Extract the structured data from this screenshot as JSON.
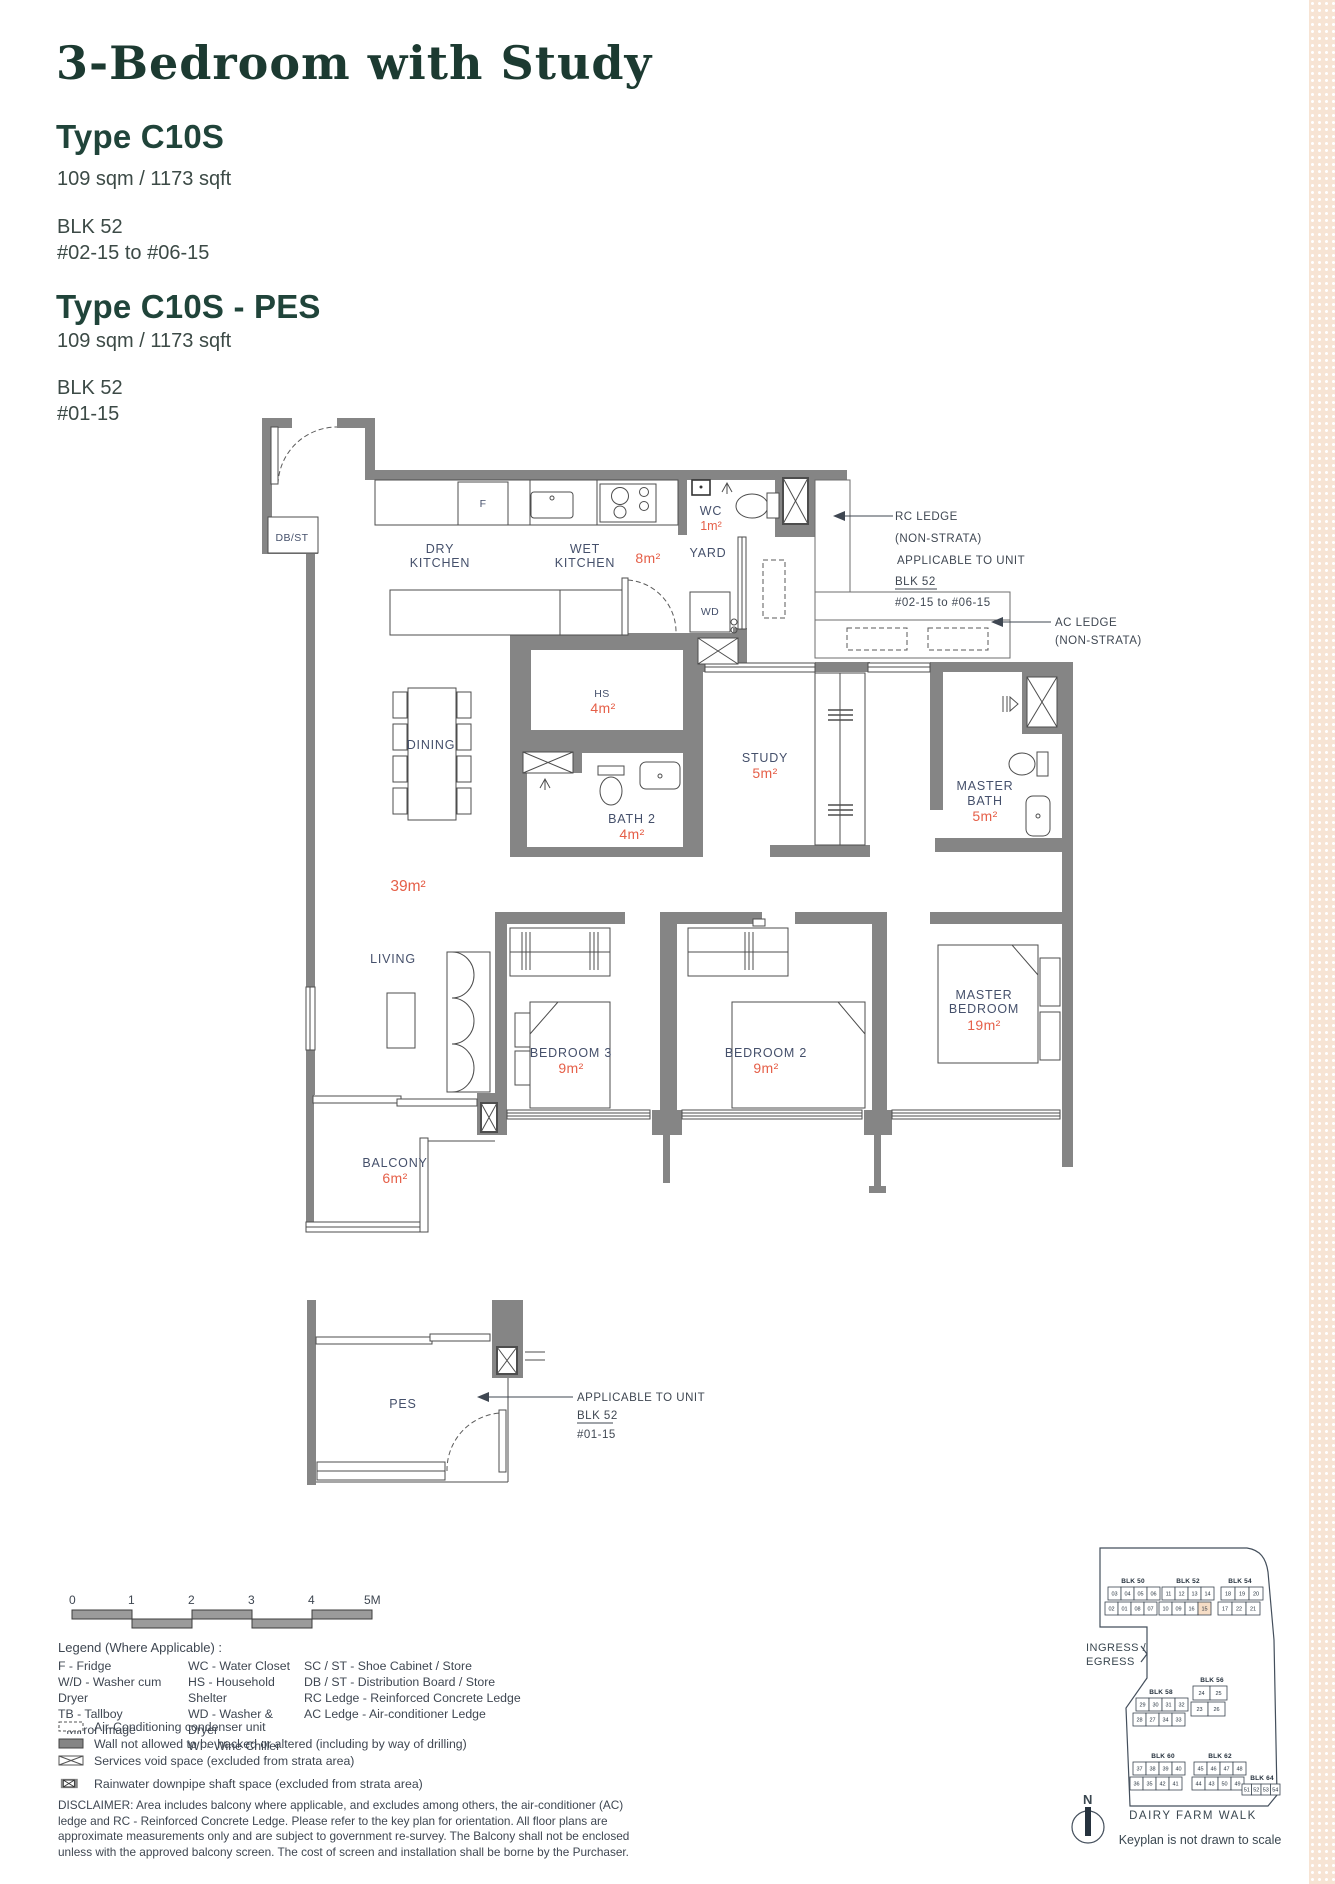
{
  "header": {
    "title": "3-Bedroom with Study",
    "types": [
      {
        "name": "Type C10S",
        "area": "109 sqm / 1173 sqft",
        "blk": "BLK 52",
        "units": "#02-15 to #06-15"
      },
      {
        "name": "Type C10S - PES",
        "area": "109 sqm / 1173 sqft",
        "blk": "BLK 52",
        "units": "#01-15"
      }
    ]
  },
  "plan": {
    "labels": {
      "db_st": "DB/ST",
      "fridge": "F",
      "dry1": "DRY",
      "dry2": "KITCHEN",
      "wet1": "WET",
      "wet2": "KITCHEN",
      "wet_area": "8m²",
      "wc": "WC",
      "wc_area": "1m²",
      "yard": "YARD",
      "wd": "WD",
      "hs": "HS",
      "hs_area": "4m²",
      "dining": "DINING",
      "bath2": "BATH 2",
      "bath2_area": "4m²",
      "study": "STUDY",
      "study_area": "5m²",
      "mbath1": "MASTER",
      "mbath2": "BATH",
      "mbath_area": "5m²",
      "living": "LIVING",
      "living_area": "39m²",
      "bed3": "BEDROOM 3",
      "bed3_area": "9m²",
      "bed2": "BEDROOM 2",
      "bed2_area": "9m²",
      "mbr1": "MASTER",
      "mbr2": "BEDROOM",
      "mbr_area": "19m²",
      "balcony": "BALCONY",
      "balcony_area": "6m²",
      "pes": "PES"
    },
    "annotations": {
      "rc": [
        "RC LEDGE",
        "(NON-STRATA)",
        "APPLICABLE TO UNIT",
        "BLK 52",
        "#02-15 to #06-15"
      ],
      "ac": [
        "AC LEDGE",
        "(NON-STRATA)"
      ],
      "pes": [
        "APPLICABLE TO UNIT",
        "BLK 52",
        "#01-15"
      ]
    }
  },
  "scale_bar": {
    "labels": [
      "0",
      "1",
      "2",
      "3",
      "4",
      "5M"
    ]
  },
  "legend": {
    "heading": "Legend (Where Applicable) :",
    "columns": [
      [
        "F - Fridge",
        "W/D - Washer cum Dryer",
        "TB - Tallboy",
        "* Mirror Image"
      ],
      [
        "WC - Water Closet",
        "HS - Household Shelter",
        "WD - Washer & Dryer",
        "WI - Wine Chiller"
      ],
      [
        "SC / ST - Shoe Cabinet / Store",
        "DB / ST - Distribution Board / Store",
        "RC Ledge - Reinforced Concrete Ledge",
        "AC Ledge - Air-conditioner Ledge"
      ]
    ],
    "symbols": [
      "Air-Conditioning condenser unit",
      "Wall not allowed to be hacked or altered (including by way of drilling)",
      "Services void space (excluded from strata area)",
      "Rainwater downpipe shaft space (excluded from strata area)"
    ]
  },
  "disclaimer": "DISCLAIMER: Area includes balcony where applicable, and excludes among others, the air-conditioner (AC) ledge and RC - Reinforced Concrete Ledge. Please refer to the key plan for orientation. All floor plans are approximate measurements only and are subject to government re-survey. The Balcony shall not be enclosed unless with the approved balcony screen. The cost of screen and installation shall be borne by the Purchaser.",
  "keyplan": {
    "ingress": [
      "INGRESS /",
      "EGRESS"
    ],
    "street": "DAIRY FARM WALK",
    "note": "Keyplan is not drawn to scale",
    "north": "N",
    "highlight_unit": "15",
    "blocks": [
      {
        "label": "BLK 50",
        "rows": [
          [
            "03",
            "04",
            "05",
            "06"
          ],
          [
            "02",
            "01",
            "08",
            "07"
          ]
        ]
      },
      {
        "label": "BLK 52",
        "rows": [
          [
            "11",
            "12",
            "13",
            "14"
          ],
          [
            "10",
            "09",
            "16",
            "15"
          ]
        ]
      },
      {
        "label": "BLK 54",
        "rows": [
          [
            "18",
            "19",
            "20"
          ],
          [
            "17",
            "22",
            "21"
          ]
        ]
      },
      {
        "label": "BLK 58",
        "rows": [
          [
            "29",
            "30",
            "31",
            "32"
          ],
          [
            "28",
            "27",
            "34",
            "33"
          ]
        ]
      },
      {
        "label": "BLK 56",
        "rows": [
          [
            "24",
            "25"
          ],
          [
            "23",
            "26"
          ]
        ]
      },
      {
        "label": "BLK 60",
        "rows": [
          [
            "37",
            "38",
            "39",
            "40"
          ],
          [
            "36",
            "35",
            "42",
            "41"
          ]
        ]
      },
      {
        "label": "BLK 62",
        "rows": [
          [
            "45",
            "46",
            "47",
            "48"
          ],
          [
            "44",
            "43",
            "50",
            "49"
          ]
        ]
      },
      {
        "label": "BLK 64",
        "rows": [
          [
            "51",
            "52",
            "53",
            "54"
          ]
        ]
      }
    ]
  },
  "colors": {
    "accent_red": "#e55f48",
    "heading_green": "#20443a",
    "wall_gray": "#858585",
    "label_slate": "#45506b",
    "strip_peach": "#f7e4d4",
    "keyplan_highlight": "#f6ddc6"
  }
}
